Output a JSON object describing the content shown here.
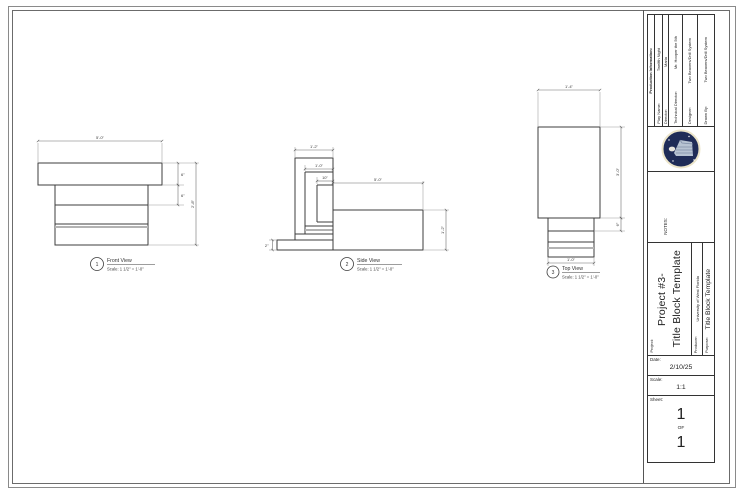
{
  "title_block": {
    "production": {
      "header": "Production Information:",
      "rows": [
        {
          "label": "Play Name:",
          "value": "Twelfth Night"
        },
        {
          "label": "Director:",
          "value": "Maria"
        },
        {
          "label": "Technical Director:",
          "value": "Mr. Hooper the 5th"
        },
        {
          "label": "Designer:",
          "value": "Two Beavers/Drill System"
        },
        {
          "label": "Drawn By:",
          "value": "Two Beavers/Drill System"
        }
      ]
    },
    "notes_label": "NOTES:",
    "project": {
      "label": "Project:",
      "line1": "Project #3-",
      "line2": "Title Block Template"
    },
    "producer": {
      "label": "Producer:",
      "value": "University of West Florida"
    },
    "purpose": {
      "label": "Purpose:",
      "value": "Title Block Template"
    },
    "date": {
      "label": "Date:",
      "value": "2/10/25"
    },
    "scale": {
      "label": "Scale:",
      "value": "1:1"
    },
    "sheet": {
      "label": "Sheet:",
      "number_top": "1",
      "of": "OF",
      "number_bottom": "1"
    }
  },
  "views": {
    "front": {
      "number": "1",
      "name": "Front View",
      "scale": "Scale: 1 1/2\" = 1'-0\"",
      "dim_width": "5'-0\"",
      "dim_h1": "6\"",
      "dim_h2": "6\"",
      "dim_total": "2'-8\""
    },
    "side": {
      "number": "2",
      "name": "Side View",
      "scale": "Scale: 1 1/2\" = 1'-0\"",
      "dim_w1": "1'-2\"",
      "dim_w2": "1'-0\"",
      "dim_w3": "10\"",
      "dim_len": "5'-0\"",
      "dim_h": "1'-2\"",
      "dim_base": "2\""
    },
    "top": {
      "number": "3",
      "name": "Top View",
      "scale": "Scale: 1 1/2\" = 1'-0\"",
      "dim_w": "1'-4\"",
      "dim_h": "3'-0\"",
      "dim_band": "6\"",
      "dim_w2": "1'-0\""
    }
  },
  "colors": {
    "logo_navy": "#1f2c57",
    "logo_ring": "#ece5c9",
    "logo_object": "#b7c3d2",
    "line_dark": "#3c3c3c",
    "line_gray": "#b3b3b3"
  }
}
